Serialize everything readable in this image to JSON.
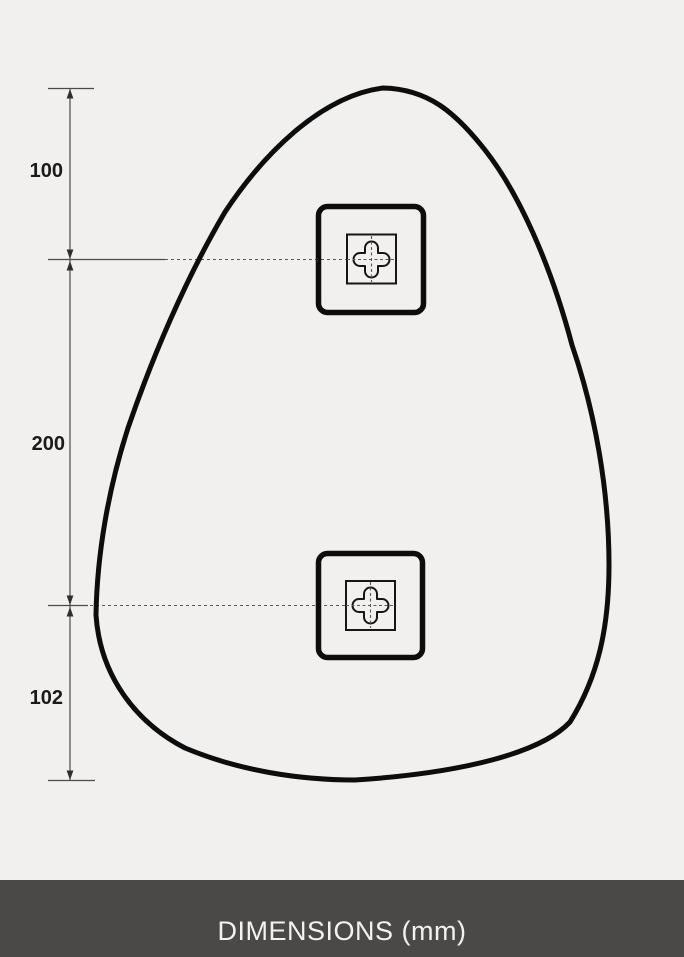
{
  "colors": {
    "background": "#f1f0ee",
    "outline": "#0d0d0d",
    "dimension_line": "#4a4a4a",
    "dashed_centerline": "#5a5a5a",
    "label_text": "#1a1a1a",
    "footer_background": "#4a4947",
    "footer_text": "#f3f2f0"
  },
  "diagram": {
    "dimension_labels": [
      {
        "name": "top-edge-to-upper-bracket",
        "value": "100"
      },
      {
        "name": "upper-bracket-to-lower-bracket",
        "value": "200"
      },
      {
        "name": "lower-bracket-to-bottom-edge",
        "value": "102"
      }
    ],
    "brackets": [
      {
        "name": "upper-mounting-bracket"
      },
      {
        "name": "lower-mounting-bracket"
      }
    ]
  },
  "footer": {
    "label": "DIMENSIONS (mm)"
  }
}
